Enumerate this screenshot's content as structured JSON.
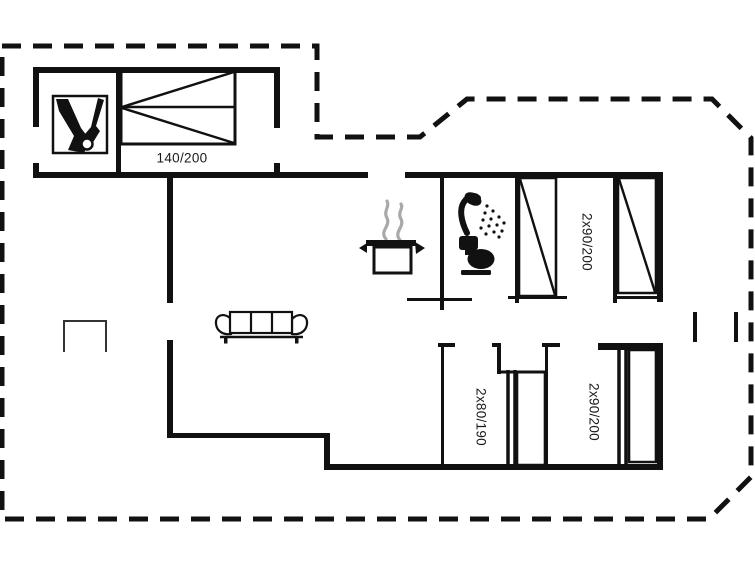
{
  "floorplan": {
    "type": "holiday-house-floor-plan",
    "labels": {
      "double_bed": "140/200",
      "bedroom_top": "2x90/200",
      "bedroom_bottom_left": "2x80/190",
      "bedroom_bottom_right": "2x90/200"
    },
    "icons": [
      "sauna-icon",
      "shower-icon",
      "toilet-icon",
      "cooking-pot-icon",
      "steam-icon",
      "sofa-icon",
      "double-bed-symbol",
      "single-bed-symbol",
      "bunk-bed-symbol",
      "terrace-marker",
      "plot-boundary-dashed"
    ],
    "colors": {
      "wall": "#111111",
      "background": "#ffffff",
      "steam": "#a9a9a9",
      "text": "#1a1a1a"
    }
  }
}
